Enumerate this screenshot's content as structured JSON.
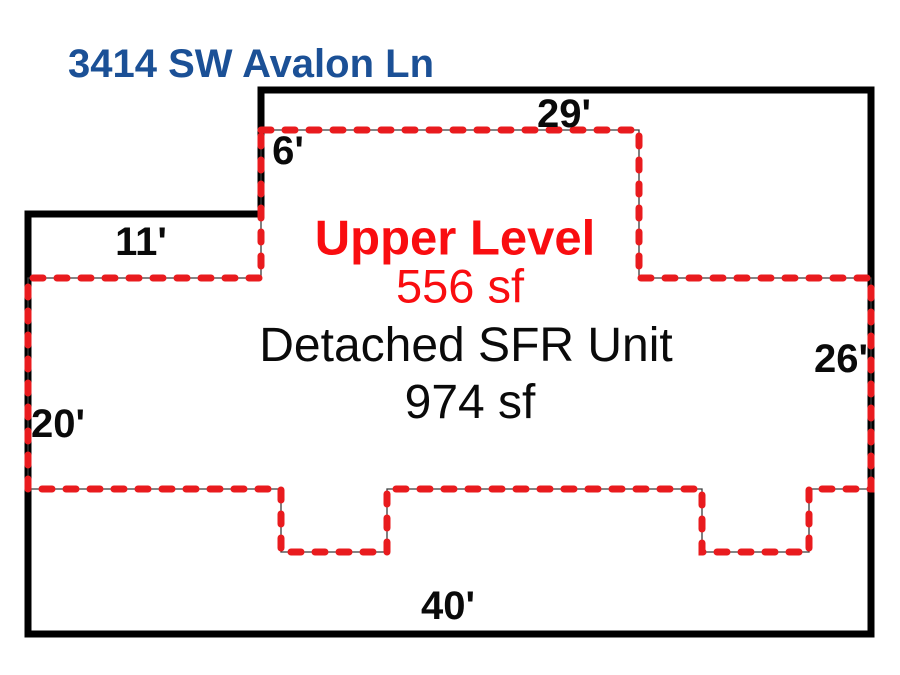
{
  "title": "3414 SW Avalon Ln",
  "floor_plan": {
    "upper_level": {
      "label": "Upper Level",
      "area": "556 sf"
    },
    "main_unit": {
      "label": "Detached SFR Unit",
      "area": "974 sf"
    },
    "dimensions": {
      "top": "29'",
      "upper_inset": "6'",
      "left_step": "11'",
      "left_side": "20'",
      "right_side": "26'",
      "bottom": "40'"
    }
  },
  "legend": {
    "building_outline_style": "solid black",
    "upper_level_outline_style": "red dashed"
  },
  "colors": {
    "title_blue": "#1b5096",
    "upper_level_red": "#f90d10",
    "dash_red": "#e91b1e",
    "outline_black": "#000000"
  }
}
